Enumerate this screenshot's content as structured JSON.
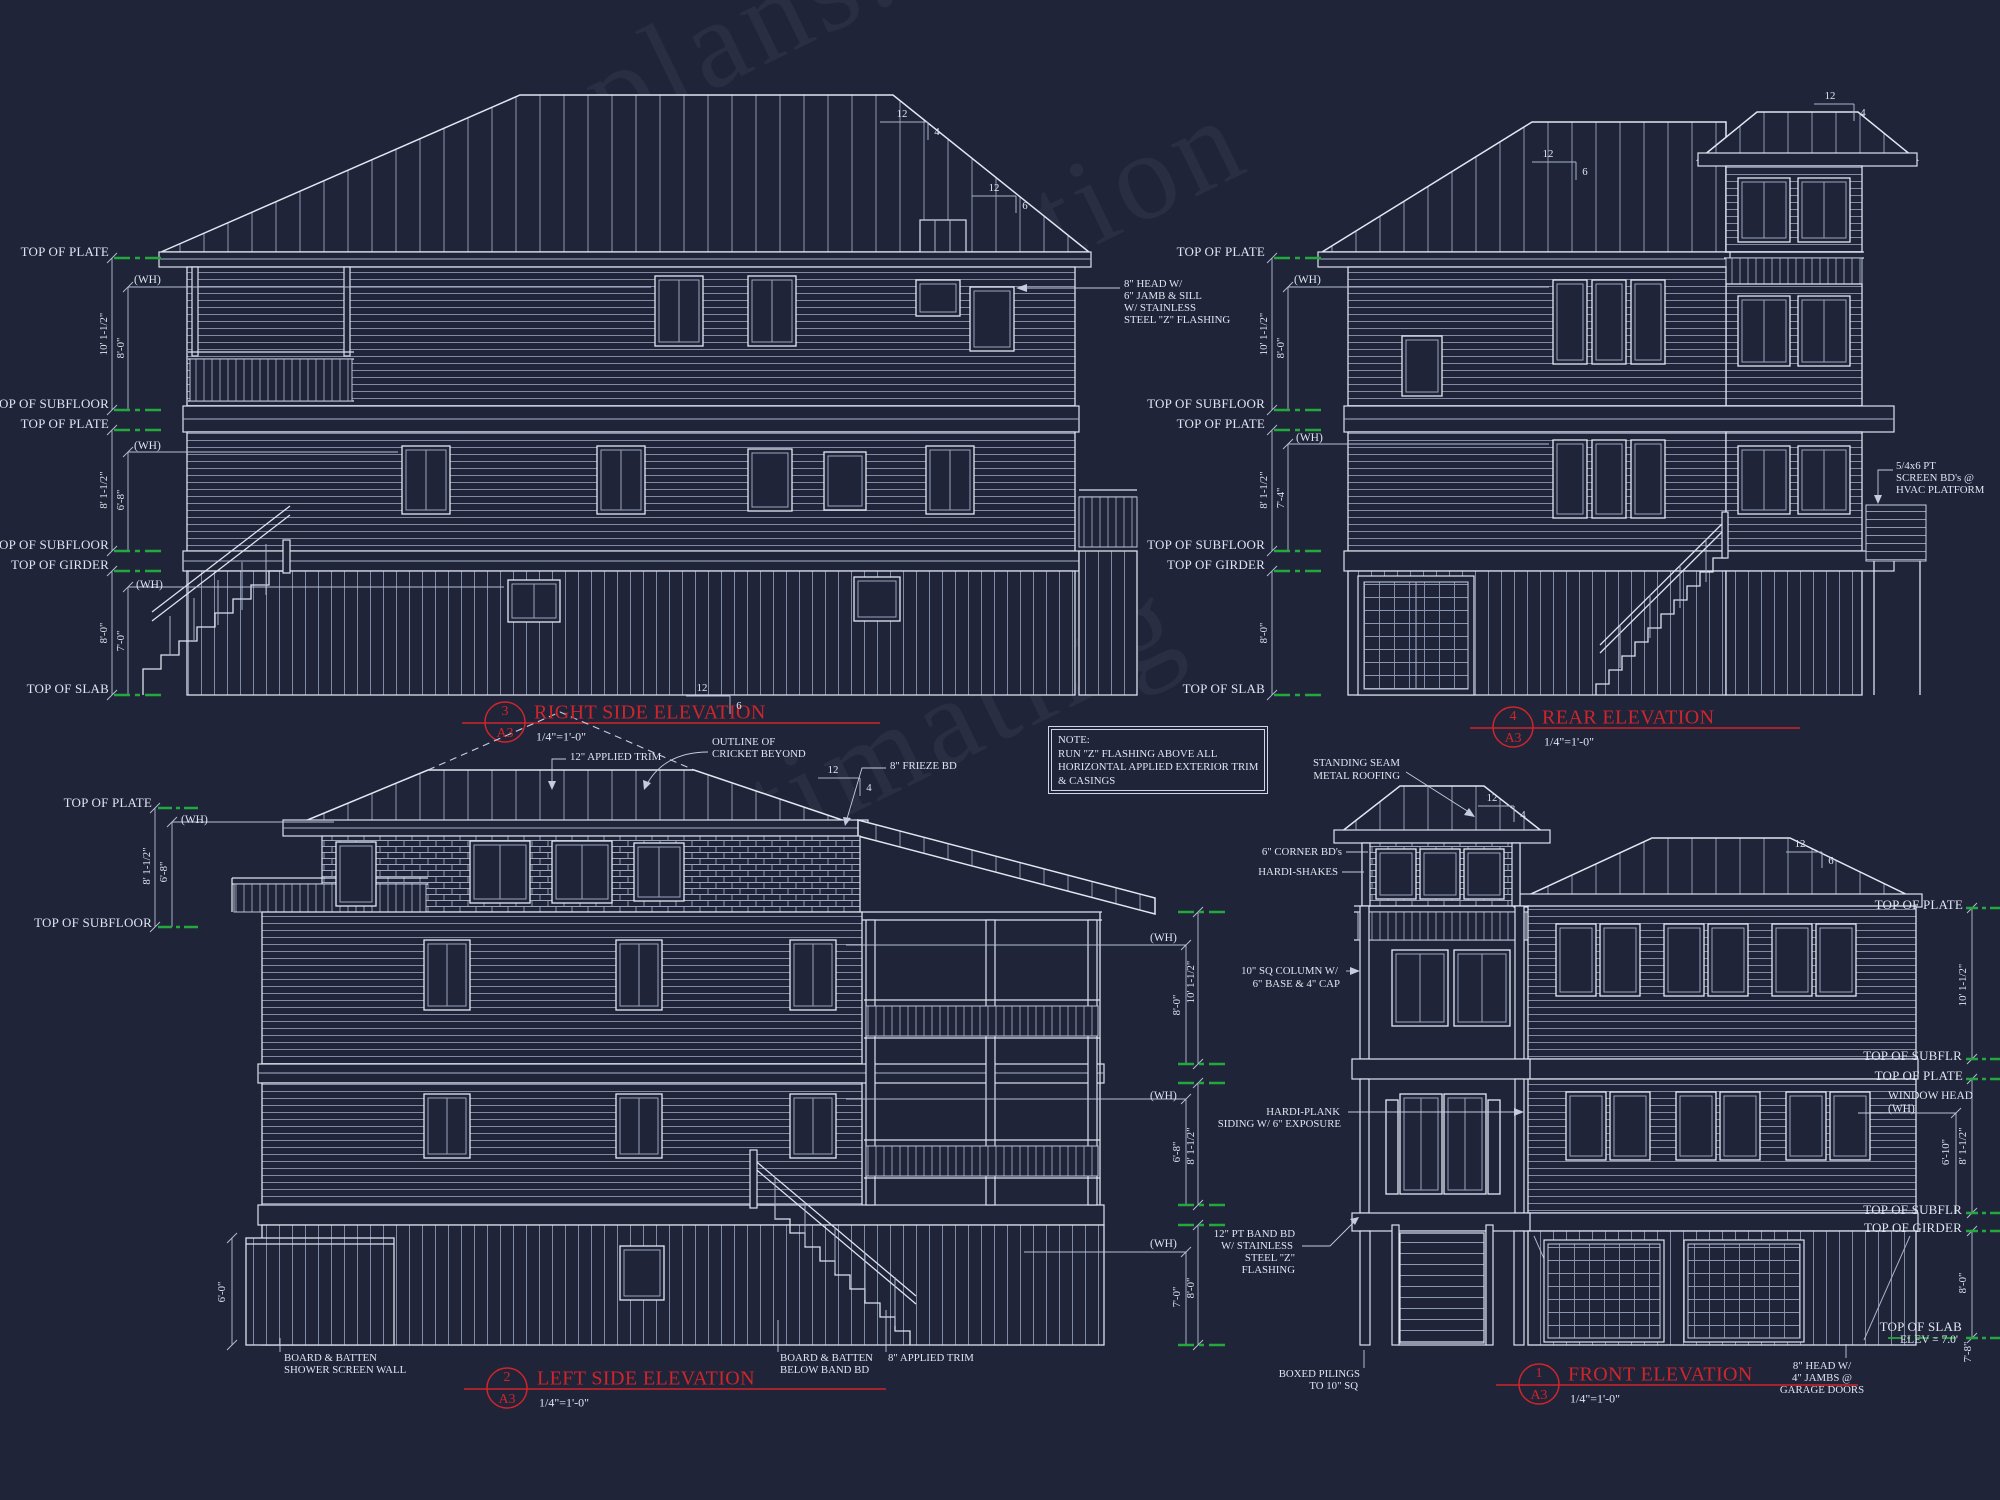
{
  "palette": {
    "background": "#1f2439",
    "line": "#dce2ee",
    "red": "#d0252b",
    "green": "#23a83c"
  },
  "watermark": {
    "lines": [
      "plans.com",
      "for Construction",
      "for Estimating"
    ]
  },
  "common": {
    "scale": "1/4\"=1'-0\"",
    "sheet": "A3"
  },
  "levels": {
    "plate": "TOP OF PLATE",
    "subfloor": "TOP OF SUBFLOOR",
    "subflr": "TOP OF SUBFLR",
    "girder": "TOP OF GIRDER",
    "slab": "TOP OF SLAB",
    "wh": "(WH)"
  },
  "pitch": {
    "run": "12",
    "rise_4": "4",
    "rise_6": "6"
  },
  "note_box": {
    "title": "NOTE:",
    "lines": [
      "RUN \"Z\" FLASHING ABOVE ALL",
      "HORIZONTAL APPLIED EXTERIOR TRIM",
      "& CASINGS"
    ]
  },
  "right_side": {
    "num": "3",
    "title": "RIGHT SIDE ELEVATION",
    "dims": {
      "f1_total": "10' 1-1/2\"",
      "f1_wh": "8'-0\"",
      "f2_total": "8' 1-1/2\"",
      "f2_wh": "6'-8\"",
      "f3_total": "8'-0\"",
      "f3_wh": "7'-0\""
    },
    "callout_head": [
      "8\" HEAD W/",
      "6\" JAMB & SILL",
      "W/ STAINLESS",
      "STEEL \"Z\" FLASHING"
    ]
  },
  "rear": {
    "num": "4",
    "title": "REAR ELEVATION",
    "dims": {
      "f1_total": "10' 1-1/2\"",
      "f1_wh": "8'-0\"",
      "f2_total": "8' 1-1/2\"",
      "f2_wh": "7'-4\"",
      "f3_total": "8'-0\""
    },
    "callout_screen": [
      "5/4x6 PT",
      "SCREEN BD's @",
      "HVAC PLATFORM"
    ]
  },
  "left_side": {
    "num": "2",
    "title": "LEFT SIDE ELEVATION",
    "dims": {
      "left_total": "8' 1-1/2\"",
      "left_wh": "6'-8\"",
      "f1_wh": "8'-0\"",
      "f1_total": "10' 1-1/2\"",
      "f2_wh": "6'-8\"",
      "f2_total": "8' 1-1/2\"",
      "f3_wh": "7'-0\"",
      "f3_total": "8'-0\"",
      "shower": "6'-0\""
    },
    "callouts": {
      "trim12": "12\" APPLIED TRIM",
      "cricket": [
        "OUTLINE OF",
        "CRICKET BEYOND"
      ],
      "frieze": "8\" FRIEZE BD",
      "bb_shower": [
        "BOARD & BATTEN",
        "SHOWER SCREEN WALL"
      ],
      "bb_band": [
        "BOARD & BATTEN",
        "BELOW BAND BD"
      ],
      "trim8": "8\" APPLIED TRIM"
    }
  },
  "front": {
    "num": "1",
    "title": "FRONT ELEVATION",
    "dims": {
      "f1_total": "10' 1-1/2\"",
      "f2_wh": "6'-10\"",
      "f2_total": "8' 1-1/2\"",
      "f3_total": "8'-0\"",
      "f4": "7'-8\""
    },
    "labels": {
      "window_head": [
        "WINDOW HEAD",
        "(WH)"
      ],
      "slab": [
        "TOP OF SLAB",
        "ELEV = 7.0'"
      ]
    },
    "callouts": {
      "roof": [
        "STANDING SEAM",
        "METAL ROOFING"
      ],
      "corner": "6\" CORNER BD's",
      "shakes": "HARDI-SHAKES",
      "column": [
        "10\" SQ COLUMN W/",
        "6\" BASE & 4\" CAP"
      ],
      "plank": [
        "HARDI-PLANK",
        "SIDING W/ 6\" EXPOSURE"
      ],
      "band": [
        "12\" PT BAND BD",
        "W/ STAINLESS",
        "STEEL \"Z\"",
        "FLASHING"
      ],
      "pilings": [
        "BOXED PILINGS",
        "TO 10\" SQ"
      ],
      "garage": [
        "8\" HEAD W/",
        "4\" JAMBS @",
        "GARAGE DOORS"
      ]
    }
  }
}
